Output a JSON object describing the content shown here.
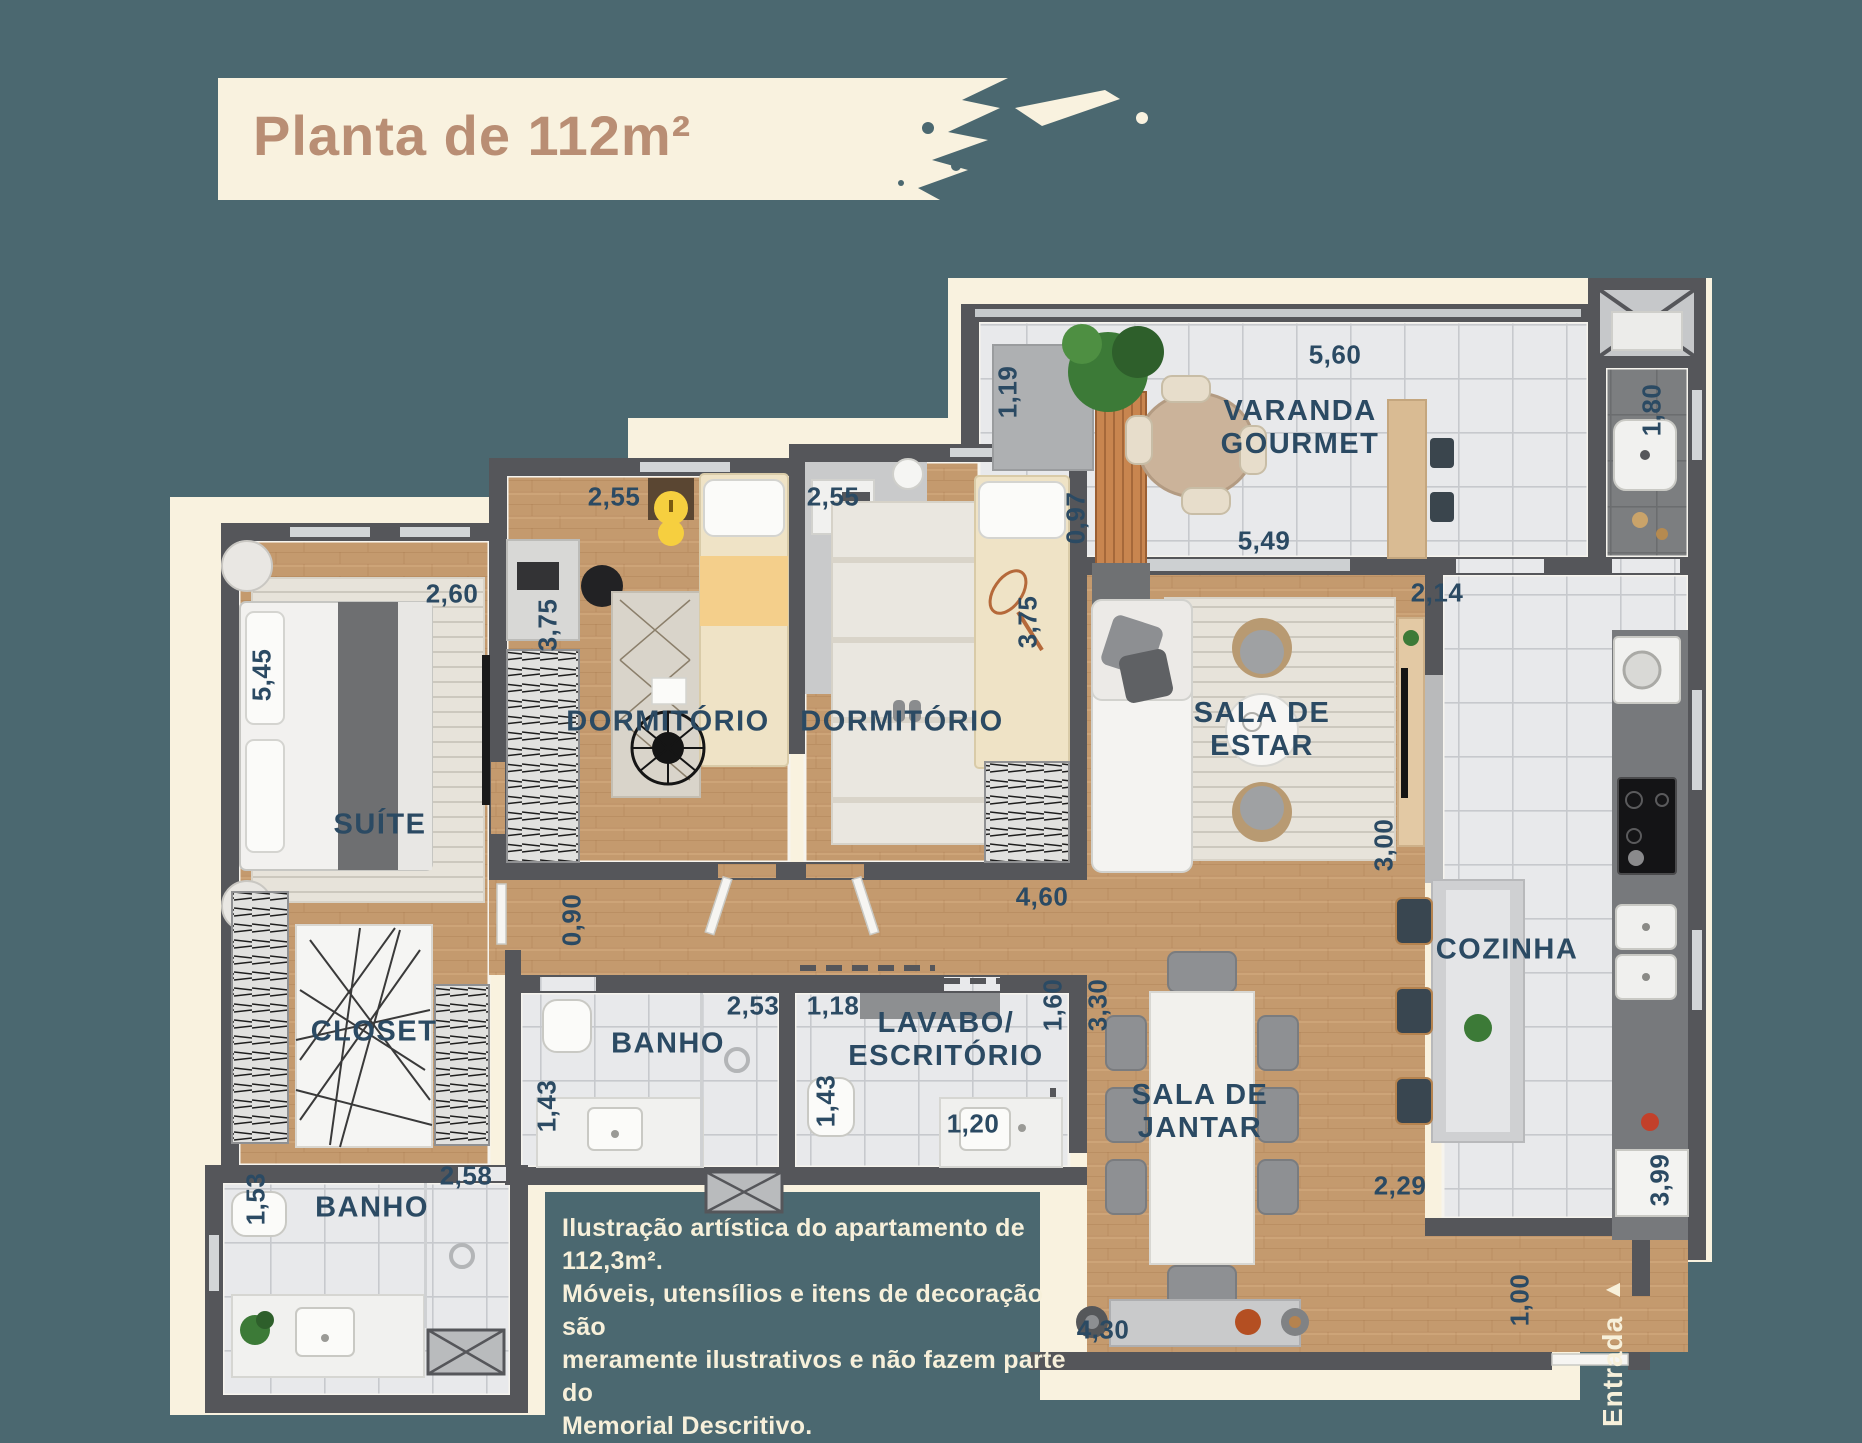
{
  "title": "Planta de 112m²",
  "rooms": {
    "suite": "SUÍTE",
    "dorm1": "DORMITÓRIO",
    "dorm2": "DORMITÓRIO",
    "varanda1": "VARANDA",
    "varanda2": "GOURMET",
    "estar1": "SALA DE",
    "estar2": "ESTAR",
    "cozinha": "COZINHA",
    "jantar1": "SALA DE",
    "jantar2": "JANTAR",
    "closet": "CLOSET",
    "banho_mid": "BANHO",
    "banho_left": "BANHO",
    "lavabo1": "LAVABO/",
    "lavabo2": "ESCRITÓRIO"
  },
  "dims": {
    "suite_w": "2,60",
    "suite_l": "5,45",
    "dorm1_w": "2,55",
    "dorm1_l": "3,75",
    "dorm2_w": "2,55",
    "dorm2_l": "3,75",
    "varanda_ac": "1,19",
    "varanda_bench": "0,97",
    "varanda_w": "5,60",
    "varanda_w2": "5,49",
    "service_w": "1,80",
    "estar_w": "2,14",
    "estar_wall": "3,00",
    "corridor": "4,60",
    "hall": "0,90",
    "banho_mid_w": "2,53",
    "banho_mid_l": "1,43",
    "lavabo_w": "1,18",
    "lavabo_l": "1,43",
    "lavabo_sink": "1,20",
    "hall2": "1,60",
    "jantar_l": "3,30",
    "banho_left_w": "2,58",
    "banho_left_l": "1,53",
    "cozinha_b": "2,29",
    "entry_w": "1,00",
    "jantar_w": "4,30",
    "cozinha_r": "3,99"
  },
  "disclaimer": [
    "Ilustração artística do apartamento de 112,3m².",
    "Móveis, utensílios e itens de decoração são",
    "meramente ilustrativos e não fazem parte do",
    "Memorial Descritivo."
  ],
  "entrance": {
    "label": "Entrada",
    "arrow": "▲"
  },
  "colors": {
    "background": "#4b6870",
    "cream": "#f9f2df",
    "wall": "#55565a",
    "label_text": "#2b4a63",
    "title_text": "#b98e74",
    "wood": "#c49a6e",
    "tile": "#e8e9eb",
    "accent_yellow": "#f6cf3f"
  }
}
